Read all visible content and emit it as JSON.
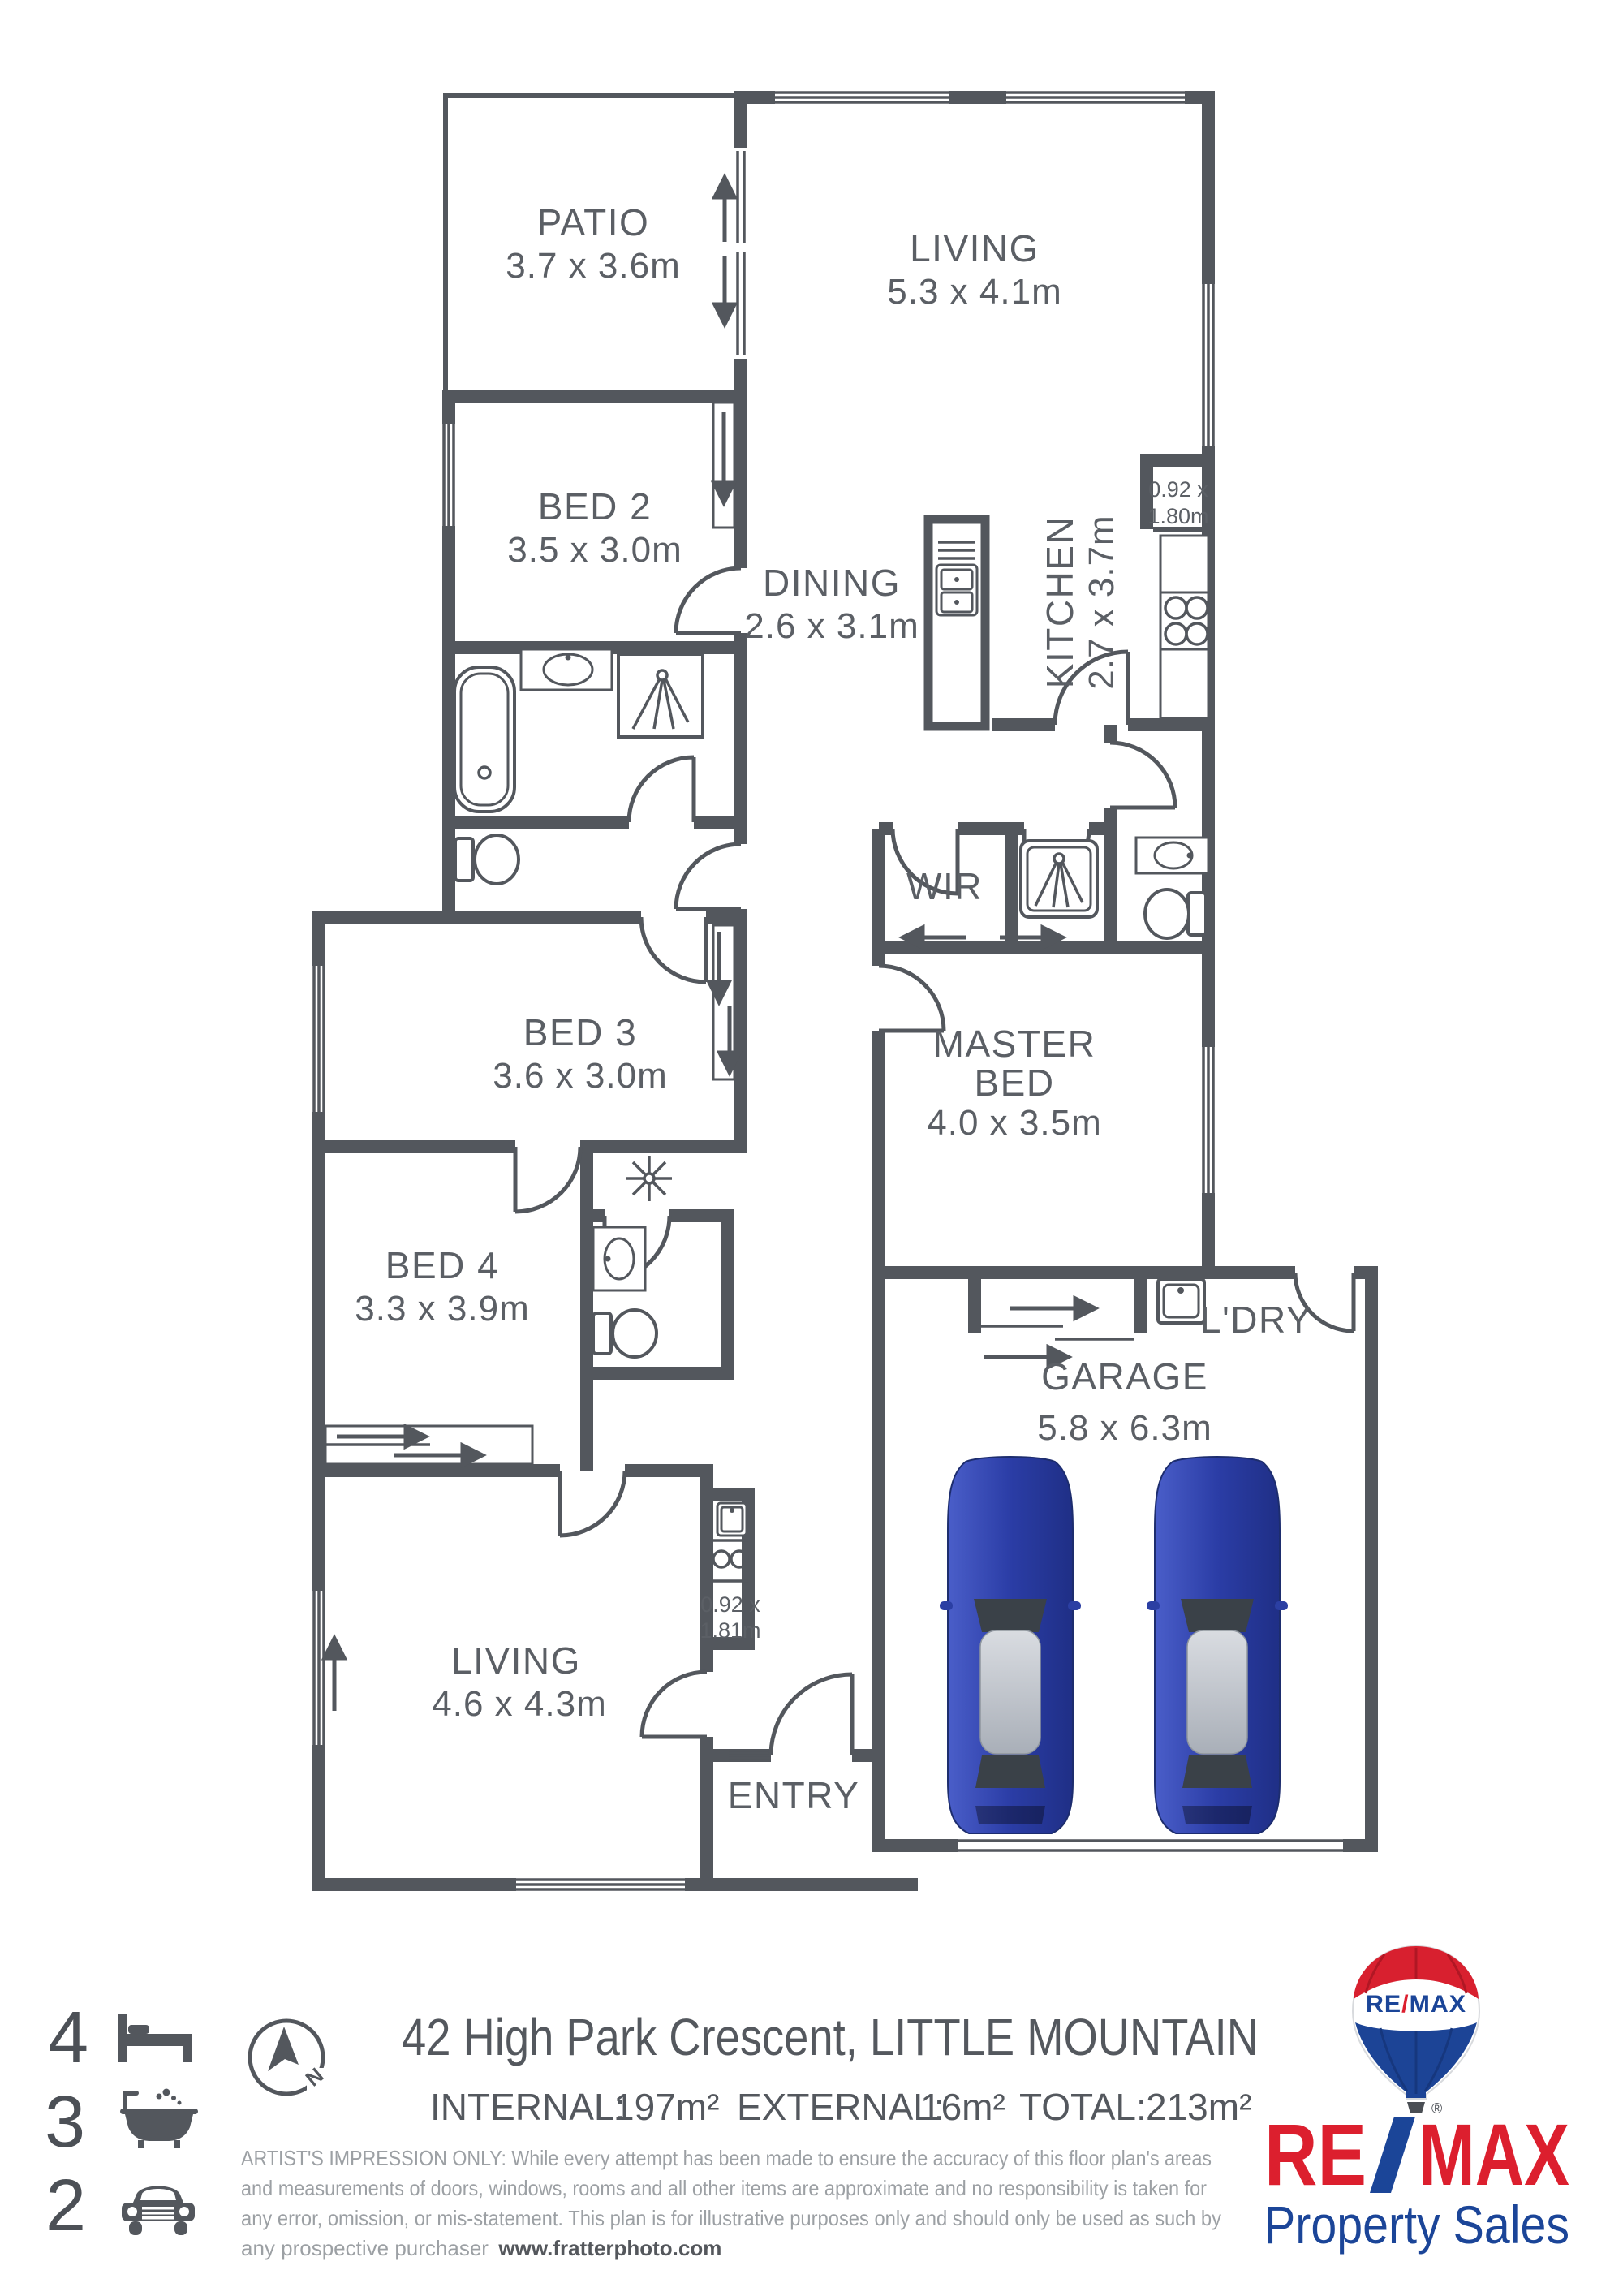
{
  "plan": {
    "wall_color": "#53575d",
    "label_color": "#5b5f65",
    "rooms": [
      {
        "id": "patio",
        "name": "PATIO",
        "size": "3.7 x 3.6m"
      },
      {
        "id": "living-top",
        "name": "LIVING",
        "size": "5.3 x 4.1m"
      },
      {
        "id": "bed2",
        "name": "BED 2",
        "size": "3.5 x 3.0m"
      },
      {
        "id": "dining",
        "name": "DINING",
        "size": "2.6 x 3.1m"
      },
      {
        "id": "kitchen",
        "name": "KITCHEN",
        "size": "2.7 x 3.7m"
      },
      {
        "id": "wir",
        "name": "WIR",
        "size": ""
      },
      {
        "id": "master",
        "name": "MASTER BED",
        "name_line1": "MASTER",
        "name_line2": "BED",
        "size": "4.0 x 3.5m"
      },
      {
        "id": "bed3",
        "name": "BED 3",
        "size": "3.6 x 3.0m"
      },
      {
        "id": "bed4",
        "name": "BED 4",
        "size": "3.3 x 3.9m"
      },
      {
        "id": "laundry",
        "name": "L'DRY",
        "size": ""
      },
      {
        "id": "garage",
        "name": "GARAGE",
        "size": "5.8 x 6.3m"
      },
      {
        "id": "living-bottom",
        "name": "LIVING",
        "size": "4.6 x 4.3m"
      },
      {
        "id": "entry",
        "name": "ENTRY",
        "size": ""
      }
    ],
    "small_dims": [
      {
        "id": "pantry-kitchen",
        "line1": "0.92 x",
        "line2": "1.80m"
      },
      {
        "id": "kitchenette-hall",
        "line1": "0.92 x",
        "line2": "1.81m"
      }
    ]
  },
  "legend": {
    "items": [
      {
        "count": "4",
        "icon": "bed-icon",
        "label": "bedrooms"
      },
      {
        "count": "3",
        "icon": "bath-icon",
        "label": "bathrooms"
      },
      {
        "count": "2",
        "icon": "car-icon",
        "label": "car spaces"
      }
    ]
  },
  "compass": {
    "north": "N"
  },
  "footer": {
    "address": "42 High Park Crescent, LITTLE MOUNTAIN",
    "areas": [
      {
        "label": "INTERNAL:",
        "value": "197m²"
      },
      {
        "label": "EXTERNAL:",
        "value": "16m²"
      },
      {
        "label": "TOTAL:",
        "value": "213m²"
      }
    ],
    "disclaimer_lines": [
      "ARTIST'S IMPRESSION ONLY: While every attempt has been made to ensure the accuracy of this floor plan's areas",
      "and measurements of doors, windows, rooms and all other items are approximate and no responsibility is taken for",
      "any error, omission, or mis-statement. This plan is for illustrative purposes only and should only be used as such by",
      "any prospective purchaser"
    ],
    "website": "www.fratterphoto.com"
  },
  "branding": {
    "balloon": {
      "re": "RE",
      "slash": "/",
      "max": "MAX"
    },
    "wordmark": {
      "re": "RE",
      "max": "MAX",
      "registered": "®"
    },
    "tagline": "Property Sales",
    "red": "#dc1f2e",
    "blue": "#1b4598"
  }
}
